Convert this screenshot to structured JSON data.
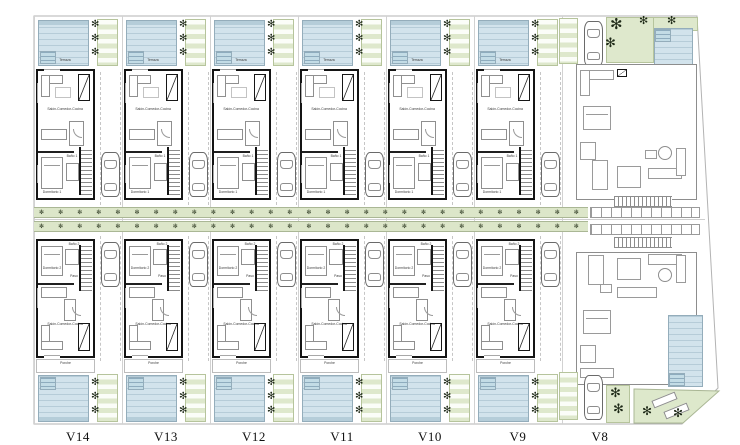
{
  "plan": {
    "type": "residential-site-plan",
    "description": "Row of mirrored villas with pools, central tree-lined driveway and corner villa"
  },
  "colors": {
    "pool": "#d2e3ec",
    "pool_border": "#94adbb",
    "green": "#dee8cc",
    "street_green": "#dce6c9",
    "wall": "#141414",
    "light_line": "#9a9a9a"
  },
  "icons": {
    "palm": "✻",
    "tree": "✻"
  },
  "rooms": {
    "terraza": "Terraza",
    "salon": "Salón-Comedor-Cocina",
    "dorm1": "Dormitorio 1",
    "bano1": "Baño 1",
    "paso": "Paso",
    "dorm2": "Dormitorio 2",
    "bano2": "Baño 2",
    "porche": "Porche"
  },
  "street": {
    "trees_per_row": 29,
    "rows": 2,
    "tree_glyph": "✻"
  },
  "villas": [
    {
      "label": "V14",
      "x": 34
    },
    {
      "label": "V13",
      "x": 122
    },
    {
      "label": "V12",
      "x": 210
    },
    {
      "label": "V11",
      "x": 298
    },
    {
      "label": "V10",
      "x": 386
    },
    {
      "label": "V9",
      "x": 474
    },
    {
      "label": "V8",
      "x": 562,
      "custom": true
    }
  ]
}
